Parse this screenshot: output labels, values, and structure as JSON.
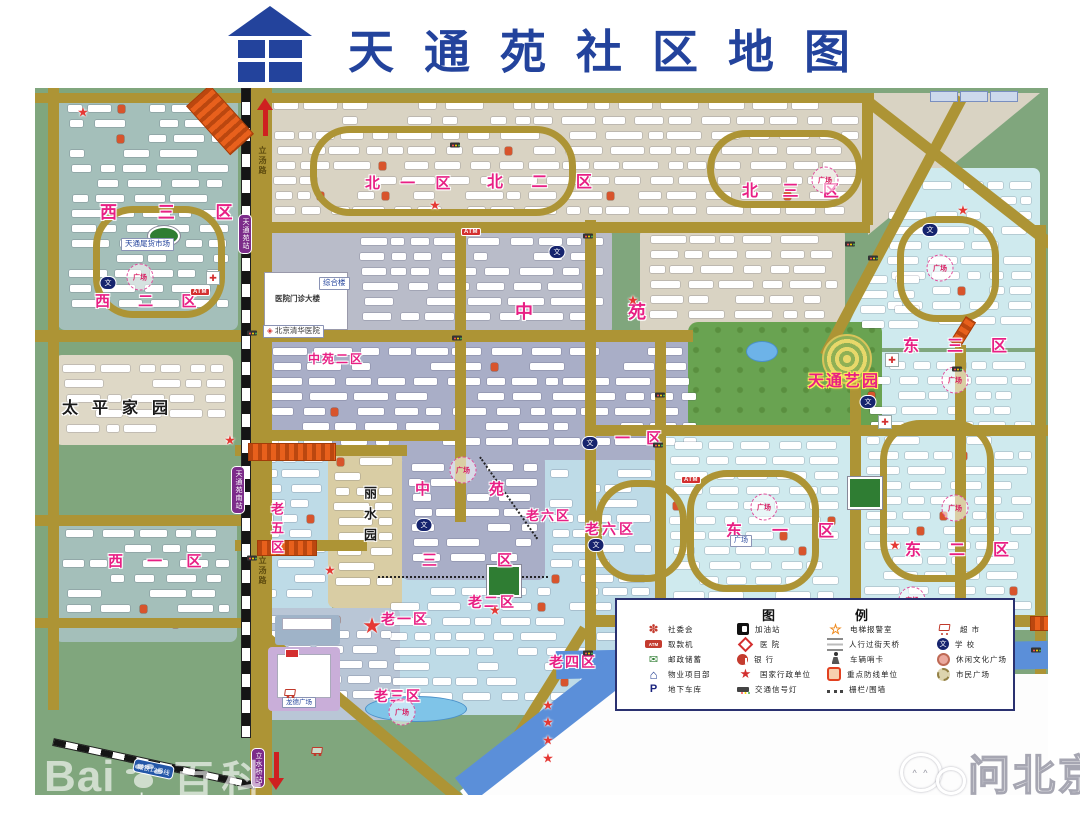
{
  "title": "天通苑社区地图",
  "districts": {
    "west3": "西 三 区",
    "west2": "西 二 区",
    "west1": "西 一 区",
    "taiping": "太平家园",
    "north1": "北 一 区",
    "north2": "北 二 区",
    "north3": "北 三 区",
    "zhongyuan": "中苑",
    "zy2": "中苑二区",
    "zy1": "一 区",
    "zy3a": "中苑",
    "zy3b": "三区",
    "lao1": "老一区",
    "lao2": "老二区",
    "lao3": "老三区",
    "lao4": "老四区",
    "lao5": "老五区",
    "lao6a": "老六区",
    "lao6b": "老六区",
    "east1": "东一区",
    "east2": "东二区",
    "east3": "东三区",
    "yiyuan": "天通艺园",
    "lishui": "丽水园",
    "qinghe": "清 河"
  },
  "landmarks": {
    "weihuo": "天通尾货市场",
    "hospital_main": "医院门诊大楼",
    "zonghelou": "综合楼",
    "tsinghua_hospital": "北京清华医院",
    "longde": "龙德广场",
    "dongplaza": "广场"
  },
  "transit": {
    "station_tiantongyuan": "天通苑站",
    "station_tiantongyuan_south": "天通苑南站",
    "station_lishuiqiao": "立水桥站",
    "line13": "城铁13号线",
    "litang_road": "立汤路"
  },
  "marker_labels": {
    "plaza": "广场",
    "atm": "ATM",
    "school": "文"
  },
  "legend": {
    "title": "图例",
    "col1": [
      {
        "icon": "committee-flower",
        "label": "社委会"
      },
      {
        "icon": "atm-tag",
        "label": "取款机"
      },
      {
        "icon": "post-savings",
        "label": "邮政储蓄"
      },
      {
        "icon": "property-house",
        "label": "物业项目部"
      },
      {
        "icon": "parking-p",
        "label": "地下车库"
      }
    ],
    "col2": [
      {
        "icon": "gas-station",
        "label": "加油站"
      },
      {
        "icon": "hospital-diamond",
        "label": "医 院"
      },
      {
        "icon": "bank-circle",
        "label": "银 行"
      },
      {
        "icon": "gov-star",
        "label": "国家行政单位"
      },
      {
        "icon": "traffic-light",
        "label": "交通信号灯"
      }
    ],
    "col3": [
      {
        "icon": "elevator-alarm-star",
        "label": "电梯报警室"
      },
      {
        "icon": "overpass-lines",
        "label": "人行过街天桥"
      },
      {
        "icon": "vehicle-checkpoint",
        "label": "车辆哨卡"
      },
      {
        "icon": "key-unit-box",
        "label": "重点防线单位"
      },
      {
        "icon": "fence-dots",
        "label": "栅栏/围墙"
      }
    ],
    "col4": [
      {
        "icon": "supermarket-cart",
        "label": "超 市"
      },
      {
        "icon": "school-dot",
        "label": "学 校"
      },
      {
        "icon": "culture-plaza",
        "label": "休闲文化广场"
      },
      {
        "icon": "civic-plaza",
        "label": "市民广场"
      }
    ]
  },
  "watermarks": {
    "baidu_a": "Bai",
    "baidu_b": "du",
    "baidu_c": "百科",
    "wenbeijing": "问北京"
  },
  "colors": {
    "title_blue": "#23439c",
    "road_olive": "#ad9435",
    "base_green": "#80a67d",
    "label_pink": "#e81f84",
    "river_blue": "#5b8fd9",
    "overpass_orange": "#e8601c"
  }
}
